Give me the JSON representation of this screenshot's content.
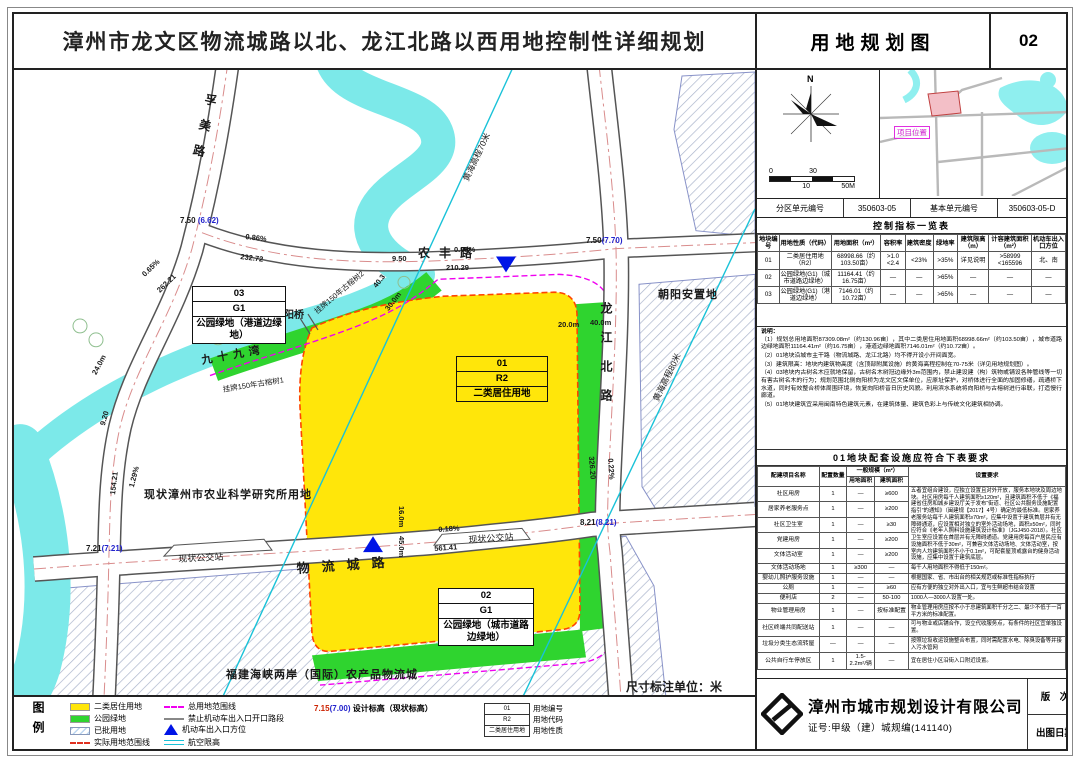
{
  "header": {
    "title": "漳州市龙文区物流城路以北、龙江北路以西用地控制性详细规划",
    "sheet_name": "用地规划图",
    "sheet_no": "02"
  },
  "locator": {
    "north": "N",
    "scale": {
      "t1": "0",
      "t2": "30",
      "b1": "10",
      "b2": "50M"
    },
    "project_label": "项目位置",
    "unit_row": {
      "l1": "分区单元编号",
      "v1": "350603-05",
      "l2": "基本单元编号",
      "v2": "350603-05-D"
    }
  },
  "control_table": {
    "title": "控制指标一览表",
    "headers": [
      "地块编号",
      "用地性质（代码）",
      "用地面积（m²）",
      "容积率",
      "建筑密度",
      "绿地率",
      "建筑限高（m）",
      "计容建筑面积（m²）",
      "机动车出入口方位"
    ],
    "rows": [
      {
        "c0": "01",
        "c1": "二类居住用地（R2）",
        "c2": "68998.66（约103.50亩）",
        "c3": ">1.0 <2.4",
        "c4": "<23%",
        "c5": ">35%",
        "c6": "详见说明",
        "c7": ">58999 <165596",
        "c8": "北、南"
      },
      {
        "c0": "02",
        "c1": "公园绿地(G1)（城市道路边绿地）",
        "c2": "11164.41（约16.75亩）",
        "c3": "—",
        "c4": "—",
        "c5": ">65%",
        "c6": "—",
        "c7": "—",
        "c8": "—"
      },
      {
        "c0": "03",
        "c1": "公园绿地(G1)（港道边绿地）",
        "c2": "7146.01（约10.72亩）",
        "c3": "—",
        "c4": "—",
        "c5": ">65%",
        "c6": "—",
        "c7": "—",
        "c8": "—"
      }
    ]
  },
  "notes": {
    "label": "说明：",
    "n1": "（1）规划总用地面积87309.08m²（约130.96亩），其中二类居住用地面积68998.66m²（约103.50亩），城市道路边绿地面积11164.41m²（约16.75亩），港道边绿地面积7146.01m²（约10.72亩）。",
    "n2": "（2）01地块沿城市主干路（物流城路、龙江北路）均不得开设小开间面宽。",
    "n3": "（3）建筑限高：地块内建筑物高度（含顶部附属设施）的黄海高程控制在70-75米（详见用地规划图）。",
    "n4": "（4）03地块内古树名木应就地保留，古树名木树冠边缘外3m范围内，禁止建设建（构）筑物或铺设各种管线等一切有害古树名木的行为；规划范围北侧向阳桥为龙文区文保单位，应原址保护，对桥体进行全面的加固修缮，疏通桥下水道，同时有效整合桥体周围环境，恢复向阳桥昔日历史风貌。利用滨水系统将向阳桥与古榕树进行串联，打造慢行廊道。",
    "n5": "（5）01地块建筑宜采用闽南特色建筑元素，在建筑体量、建筑色彩上与传统文化建筑相协调。"
  },
  "facility_table": {
    "title": "01地块配套设施应符合下表要求",
    "h_name": "配建项目名称",
    "h_qty": "配置数量",
    "h_scale": "一般规模（m²）",
    "h_land": "用地面积",
    "h_floor": "建筑面积",
    "h_req": "设置要求",
    "merged_req": "五者宜组合建设，应独立设置且对外开放，服务本地块及周边地块。社区用房每千人建筑面积≥120m²，且建筑面积不低于《福建省住房和城乡建设厅关于发布“街道、社区公共服务设施配置指引”的通知》（闽建规【2017】4号）确定的最低标准。居家养老服务站每千人建筑面积≥70m²，应集中设置于建筑首层并有无障碍通道，应设置相对独立的室外活动场地，面积≥50m²，同时应符合《老年人照料设施建筑设计标准》（JGJ450-2018）。社区卫生室应设置在首层并有无障碍通道。党建用房每百户居民应有设施面积不低于30m²，可兼容文体活动场地、文体活动室，按室内人均建筑面积不小于0.1m²，可配套屋顶或露台的健身活动设施，应集中设置于建筑底层。",
    "rows": [
      {
        "name": "社区用房",
        "qty": "1",
        "land": "—",
        "floor": "≥600",
        "req": ""
      },
      {
        "name": "居家养老服务点",
        "qty": "1",
        "land": "—",
        "floor": "≥200",
        "req": ""
      },
      {
        "name": "社区卫生室",
        "qty": "1",
        "land": "—",
        "floor": "≥30",
        "req": ""
      },
      {
        "name": "党建用房",
        "qty": "1",
        "land": "—",
        "floor": "≥200",
        "req": ""
      },
      {
        "name": "文体活动室",
        "qty": "1",
        "land": "—",
        "floor": "≥200",
        "req": ""
      },
      {
        "name": "文体活动场地",
        "qty": "1",
        "land": "≥300",
        "floor": "—",
        "req": "每千人用地面积不得低于150m²。"
      },
      {
        "name": "婴幼儿照护服务设施",
        "qty": "1",
        "land": "—",
        "floor": "—",
        "req": "根据国家、省、市出台的相关规范或标准性指标执行"
      },
      {
        "name": "公厕",
        "qty": "1",
        "land": "—",
        "floor": "≥60",
        "req": "应有方便的独立对外出入口，宜与生鲜超市结合设置"
      },
      {
        "name": "便利店",
        "qty": "2",
        "land": "—",
        "floor": "50-100",
        "req": "1000人—3000人设置一处。"
      },
      {
        "name": "物业管理用房",
        "qty": "1",
        "land": "—",
        "floor": "按标准配置",
        "req": "物业管理用房应按不小于总建筑面积千分之二、最少不低于一百平方米的标准配置。"
      },
      {
        "name": "社区终端共同配送站",
        "qty": "1",
        "land": "—",
        "floor": "—",
        "req": "可与物业或店铺合作，设立代收服务点，有条件的社区宜单独设置。"
      },
      {
        "name": "垃圾分类生态流转屋",
        "qty": "—",
        "land": "—",
        "floor": "—",
        "req": "按照垃圾收运设施整合布置，同时需配置水电、除臭设备等并接入污水管网"
      },
      {
        "name": "公共自行车停放区",
        "qty": "1",
        "land": "1.5-2.2m²/辆",
        "floor": "—",
        "req": "宜在居住小区沿街入口附近设置。"
      }
    ]
  },
  "company": {
    "name": "漳州市城市规划设计有限公司",
    "cert": "证号:甲级（建）城规编(141140)",
    "version_label": "版　次",
    "version": "1",
    "date_label": "出图日期",
    "date": "2020.09"
  },
  "legend": {
    "title": "图例",
    "items1": [
      {
        "label": "二类居住用地"
      },
      {
        "label": "公园绿地"
      },
      {
        "label": "已批用地"
      },
      {
        "label": "实际用地范围线"
      }
    ],
    "items2": [
      {
        "label": "总用地范围线"
      },
      {
        "label": "禁止机动车出入口开口路段"
      },
      {
        "label": "机动车出入口方位"
      },
      {
        "label": "航空限高"
      }
    ],
    "elev_design": "7.15",
    "elev_exist": "(7.00)",
    "elev_label": "设计标高（现状标高）",
    "mini": {
      "r1c": "01",
      "r1l": "用地编号",
      "r2c": "R2",
      "r2l": "用地代码",
      "r3c": "二类居住用地",
      "r3l": "用地性质"
    }
  },
  "map": {
    "unit_note": "尺寸标注单位：米",
    "blocks": {
      "b01": {
        "r1": "01",
        "r2": "R2",
        "r3": "二类居住用地"
      },
      "b02": {
        "r1": "02",
        "r2": "G1",
        "r3": "公园绿地（城市道路边绿地）"
      },
      "b03": {
        "r1": "03",
        "r2": "G1",
        "r3": "公园绿地（港道边绿地）"
      }
    },
    "roads": {
      "fumei": "孚美路",
      "nongfeng": "农丰路",
      "longjiang": "龙江北路",
      "wuliu": "物流城路"
    },
    "features": {
      "river": "九十九湾",
      "bridge": "向阳桥",
      "tree1": "挂牌150年古榕树1",
      "tree2": "挂牌150年古榕树2",
      "nongke": "现状漳州市农业科学研究所用地",
      "chaoyang": "朝阳安置地",
      "wuliucheng": "福建海峡两岸（国际）农产品物流城",
      "bus1": "现状公交站",
      "bus2": "现状公交站",
      "hh70": "黄海高程70米",
      "hh80": "黄海高程80米"
    },
    "dims": {
      "d086": "0.86%",
      "d23272": "232.72",
      "d065": "0.65%",
      "d26221": "262.21",
      "d950": "9.50",
      "d095": "0.95%",
      "d21029": "210.29",
      "d240": "24.0m",
      "d920": "9.20",
      "d15421": "154.21",
      "d129": "1.29%",
      "d403": "40.3",
      "d300": "30.0m",
      "d200": "20.0m",
      "d400": "40.0m",
      "d32620": "326.20",
      "d022": "0.22%",
      "d160": "16.0m",
      "d450": "45.0m",
      "d018": "0.18%",
      "d56141": "561.41"
    },
    "elevs": {
      "e1": {
        "d": "7.50",
        "e": "(6.62)"
      },
      "e2": {
        "d": "7.50",
        "e": "(7.70)"
      },
      "e3": {
        "d": "8.21",
        "e": "(8.21)"
      },
      "e4": {
        "d": "7.21",
        "e": "(7.21)"
      }
    }
  }
}
